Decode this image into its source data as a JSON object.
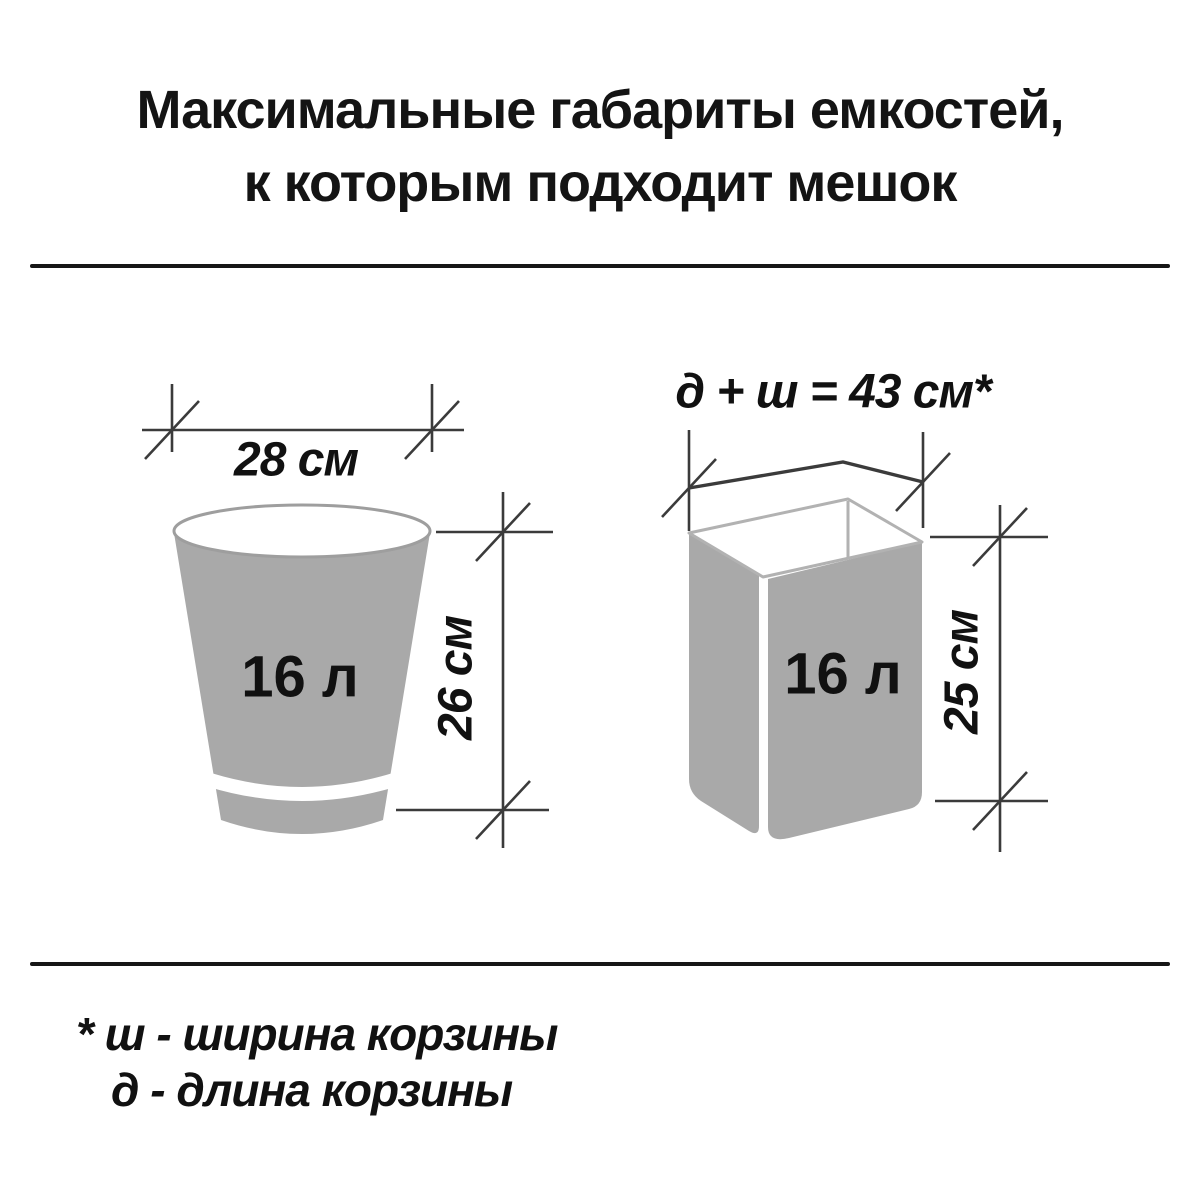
{
  "title": {
    "line1": "Максимальные габариты емкостей,",
    "line2": "к которым подходит мешок"
  },
  "left_container": {
    "width_label": "28 см",
    "height_label": "26 см",
    "volume_label": "16 л"
  },
  "right_container": {
    "formula_label": "д + ш = 43 см*",
    "height_label": "25 см",
    "volume_label": "16 л"
  },
  "footnotes": {
    "line1": "* ш - ширина корзины",
    "line2": "д  - длина корзины"
  },
  "colors": {
    "background": "#ffffff",
    "text": "#141414",
    "container_fill": "#a9a9a9",
    "bucket_rim_stroke": "#9e9e9e",
    "basket_rim_stroke": "#b2b2b2",
    "dimension_line": "#3b3b3b",
    "separator": "#161616"
  }
}
